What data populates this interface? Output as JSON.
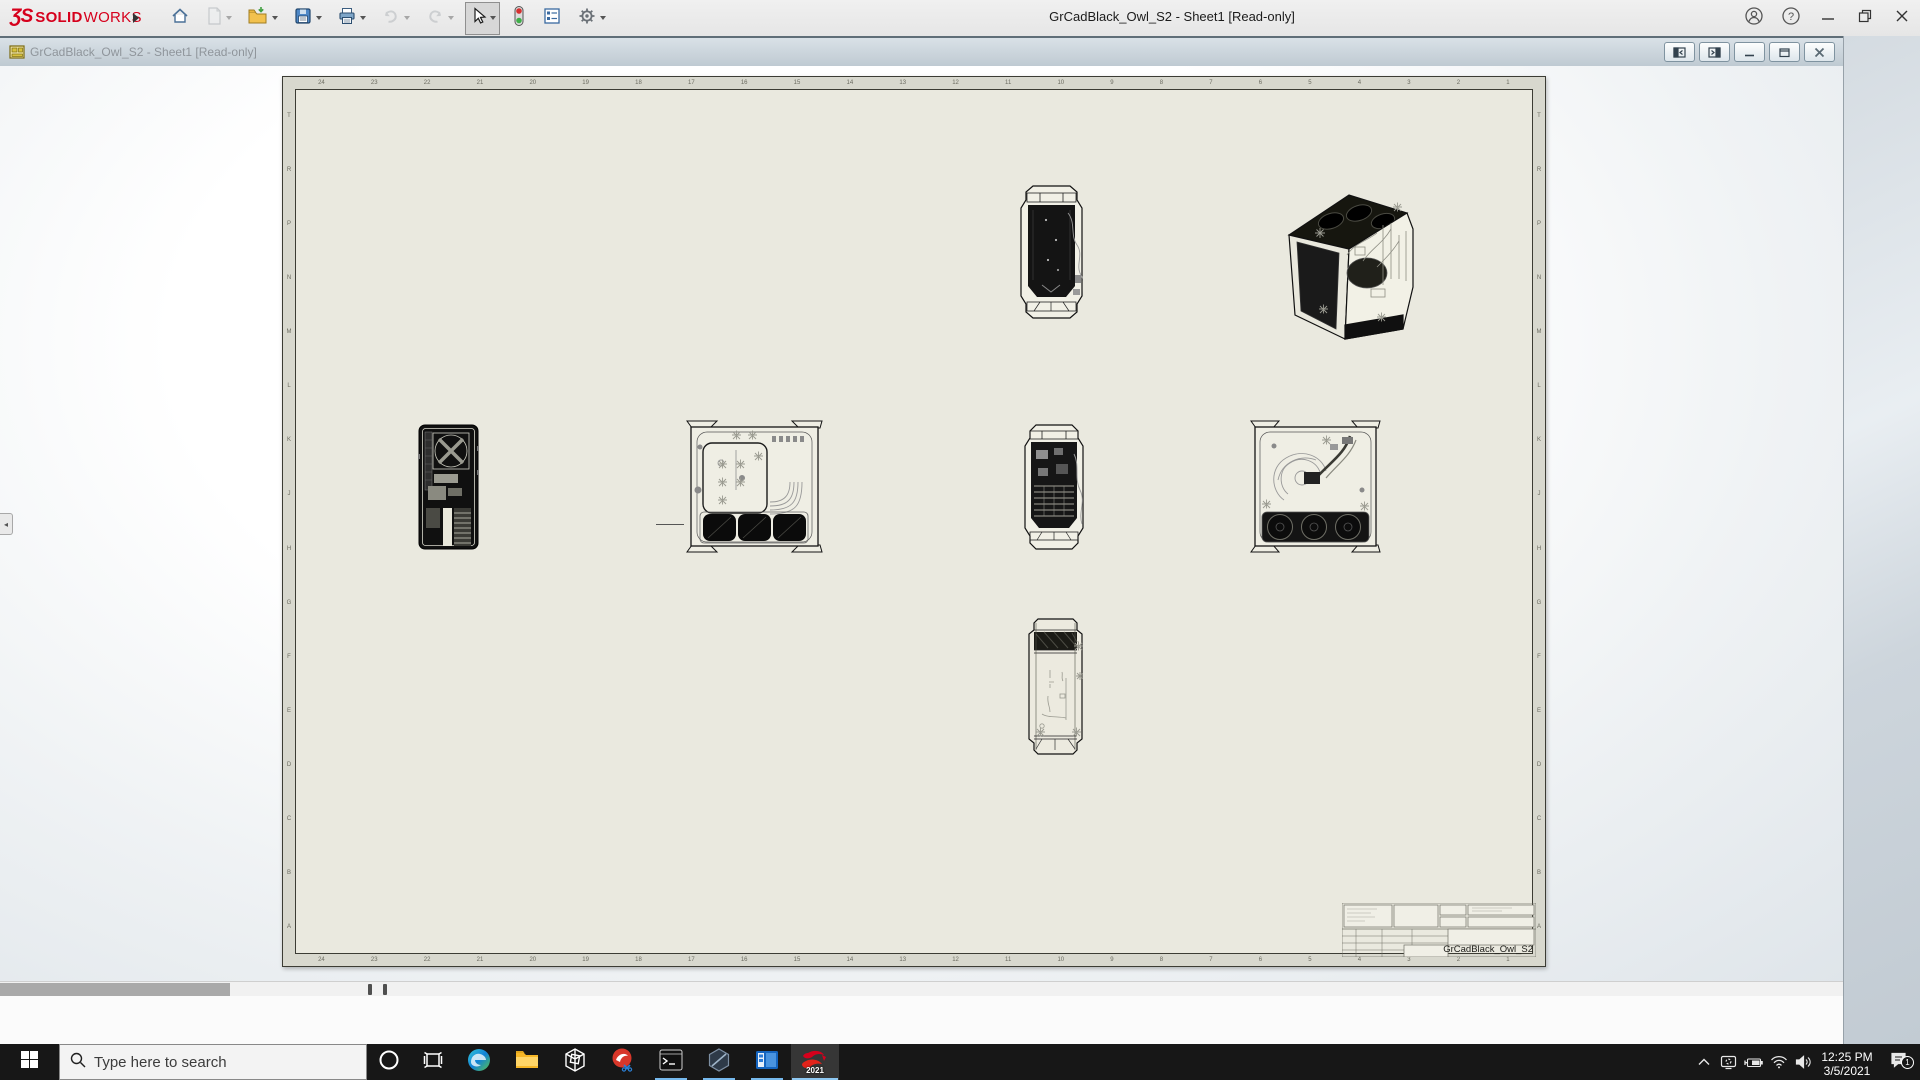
{
  "colors": {
    "sw-red": "#d6001c",
    "taskbar-bg": "#171717",
    "accent-underline": "#76b9ed",
    "sheet-paper": "#eae9df",
    "zone-band": "#d8d8ce",
    "docbar-text": "#8f959b"
  },
  "app": {
    "window_title": "GrCadBlack_Owl_S2 - Sheet1 [Read-only]",
    "brand": {
      "glyph": "ƷS",
      "name_bold": "SOLID",
      "name_light": "WORKS"
    },
    "toolbar_icons": [
      "home",
      "new-document",
      "open",
      "save",
      "print",
      "undo",
      "redo",
      "select-cursor",
      "rebuild-stoplight",
      "display-report",
      "options-gear"
    ],
    "titlebar_icons": [
      "account",
      "help",
      "minimize",
      "restore",
      "close"
    ]
  },
  "document_window": {
    "title": "GrCadBlack_Owl_S2 - Sheet1 [Read-only]",
    "control_icons": [
      "pane-left",
      "pane-right",
      "minimize",
      "restore",
      "close"
    ]
  },
  "sheet": {
    "zone_numbers": [
      "24",
      "23",
      "22",
      "21",
      "20",
      "19",
      "18",
      "17",
      "16",
      "15",
      "14",
      "13",
      "12",
      "11",
      "10",
      "9",
      "8",
      "7",
      "6",
      "5",
      "4",
      "3",
      "2",
      "1"
    ],
    "zone_letters": [
      "T",
      "R",
      "P",
      "N",
      "M",
      "L",
      "K",
      "J",
      "H",
      "G",
      "F",
      "E",
      "D",
      "C",
      "B",
      "A"
    ],
    "title_block": {
      "part_name": "GrCadBlack_Owl_S2"
    },
    "views": [
      "front-top",
      "isometric",
      "rear",
      "left-side",
      "front-middle",
      "right-side",
      "top"
    ]
  },
  "taskbar": {
    "search_placeholder": "Type here to search",
    "app_icons": [
      "edge",
      "file-explorer",
      "3d-viewer",
      "capture-tool",
      "command-prompt",
      "hex-app",
      "remote-window",
      "solidworks-2021"
    ],
    "tray_icons": [
      "hidden-icons-chevron",
      "connect-display",
      "battery-charging",
      "wifi",
      "volume"
    ],
    "solidworks_badge": "2021",
    "clock": {
      "time": "12:25 PM",
      "date": "3/5/2021"
    },
    "notifications": {
      "count": "1"
    }
  }
}
